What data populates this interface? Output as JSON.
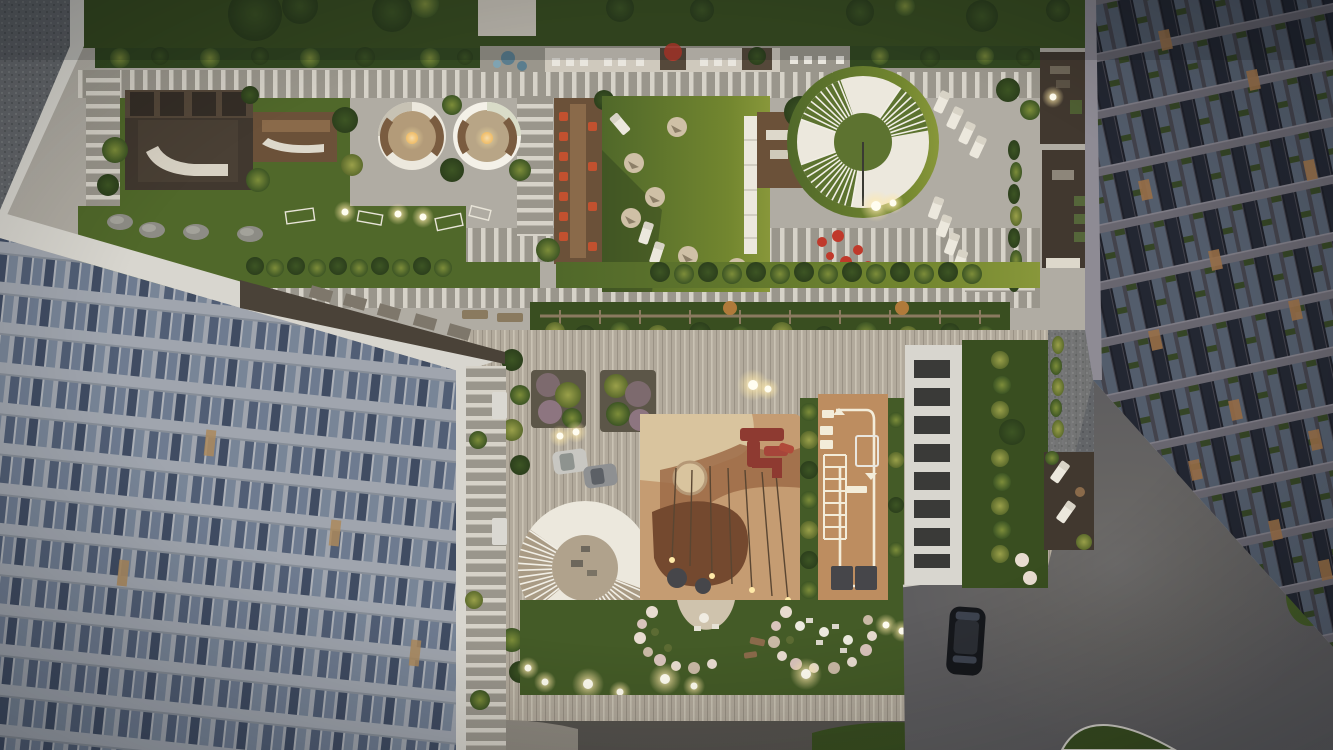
{
  "image_type": "aerial-dusk-render",
  "description": "Top-down architectural rendering of a residential complex at dusk: a landscaped podium rooftop terrace (upper half), a ground-level courtyard with playground and sports area (lower half), flanked by a light apartment building on the left and a dark apartment building on the right, with a paved plaza and one parked black car at bottom right.",
  "palette": {
    "paving": "#b0aca3",
    "pavingLight": "#cfc9bd",
    "pavingStripe": "#d6d2c8",
    "pavingDark": "#9a968c",
    "plankBase": "#b2aa9c",
    "plankLine": "#c9c2b3",
    "plankShadow": "#9a9285",
    "grass": "#50682a",
    "grassLit": "#72862f",
    "grassDark": "#394e20",
    "grassCourt": "#445b27",
    "treeDark": "#2c3f1c",
    "treeMid": "#3d5524",
    "bushLight": "#7d8d3a",
    "bushYellow": "#9aa04a",
    "hedge": "#324820",
    "gravel": "#63666a",
    "gravelLight": "#9a958f",
    "deckDark": "#41382f",
    "deckWarm": "#6b5139",
    "deckMid": "#55483a",
    "woodTable": "#8a6a4a",
    "white": "#ece8dd",
    "whiteBright": "#f4f1e8",
    "parapet": "#d8d6cf",
    "orangeChair": "#c2512f",
    "redFlower": "#c0392b",
    "redPlay": "#8e3a31",
    "redPlayLight": "#a6453a",
    "playTan": "#c59c72",
    "playSand": "#d9c49e",
    "playBrown": "#9c6b47",
    "playDarkBrown": "#74492f",
    "sportTan": "#bd8d60",
    "sportLine": "#f3ecd9",
    "matGrey": "#46464a",
    "asphalt": "#5e5d5f",
    "road": "#56534e",
    "carBlack": "#16181c",
    "carRoof": "#2c2f35",
    "carWhite": "#c8c7c2",
    "carGrey": "#8e9092",
    "glowCore": "#fffdf0",
    "glowWarm": "#ffe9a8",
    "fireGlow": "#e8a84e",
    "leftBand": "#b6bbc3",
    "leftBandShade": "#99a0a9",
    "leftWin1": "#5a6880",
    "leftWin2": "#7c8aa0",
    "leftWin3": "#46536b",
    "leftWin4": "#8795a8",
    "litWindow": "#c49a62",
    "rightBase": "#4b4a54",
    "rightBand": "#75727c",
    "rightBandHi": "#8e8b94",
    "rightWin1": "#5d6878",
    "rightWin2": "#262b36",
    "rightLit": "#ab7c4e",
    "planterGreen": "#3b4d28",
    "blossom": "#e8dcd0",
    "blossomPink": "#d9c4bc",
    "rock": "#8d8c85",
    "fence": "#8a7a5f",
    "blueTable": "#5a7d8e"
  },
  "scene": {
    "upper_terrace": {
      "features": [
        "top-lawn-with-trees",
        "gravel-roof-corner",
        "striped-walkways",
        "timber-pavilion",
        "long-table-deck",
        "fire-pit-lounge-1",
        "fire-pit-lounge-2",
        "dining-deck-orange-chairs",
        "bean-bag-lawn",
        "white-linear-bench",
        "round-pergola-white-ring",
        "sun-loungers",
        "sphere-lamps",
        "red-flower-bed",
        "hedge-rows",
        "rooftop-seating-row",
        "rock-garden",
        "wireframe-play-frames"
      ],
      "round_pergola": {
        "center_x": 863,
        "center_y": 142,
        "outer_r": 66,
        "inner_r": 29
      },
      "lamp_count": 6
    },
    "courtyard": {
      "features": [
        "plank-paving",
        "flower-planters",
        "parked-car-white",
        "parked-car-grey",
        "round-pergola-white-ring",
        "kids-playground",
        "red-play-structure",
        "sand-circle",
        "trampolines",
        "swing-lines",
        "workout-zone-white-loop",
        "rubber-mats",
        "lawn-with-blossom-arcs",
        "cafe-tables",
        "sphere-lamps",
        "white-gallery-roof",
        "side-deck-loungers",
        "entrance-canopies"
      ],
      "round_pergola": {
        "center_x": 585,
        "center_y": 568,
        "outer_r": 67,
        "inner_r": 33
      },
      "lamp_count": 10
    },
    "plaza": {
      "features": [
        "asphalt-surface",
        "black-parked-car",
        "curved-lawn-edges",
        "kerb-lines"
      ]
    },
    "buildings": {
      "left": {
        "tone": "light-grey-blue",
        "floors_visible": 6,
        "style": "horizontal-band-facade"
      },
      "right": {
        "tone": "dark-slate",
        "style": "grid-facade-lit-windows-green-planters"
      }
    },
    "lighting": "dusk, warm low light from right, glowing sphere path lamps, lit apartment windows"
  }
}
